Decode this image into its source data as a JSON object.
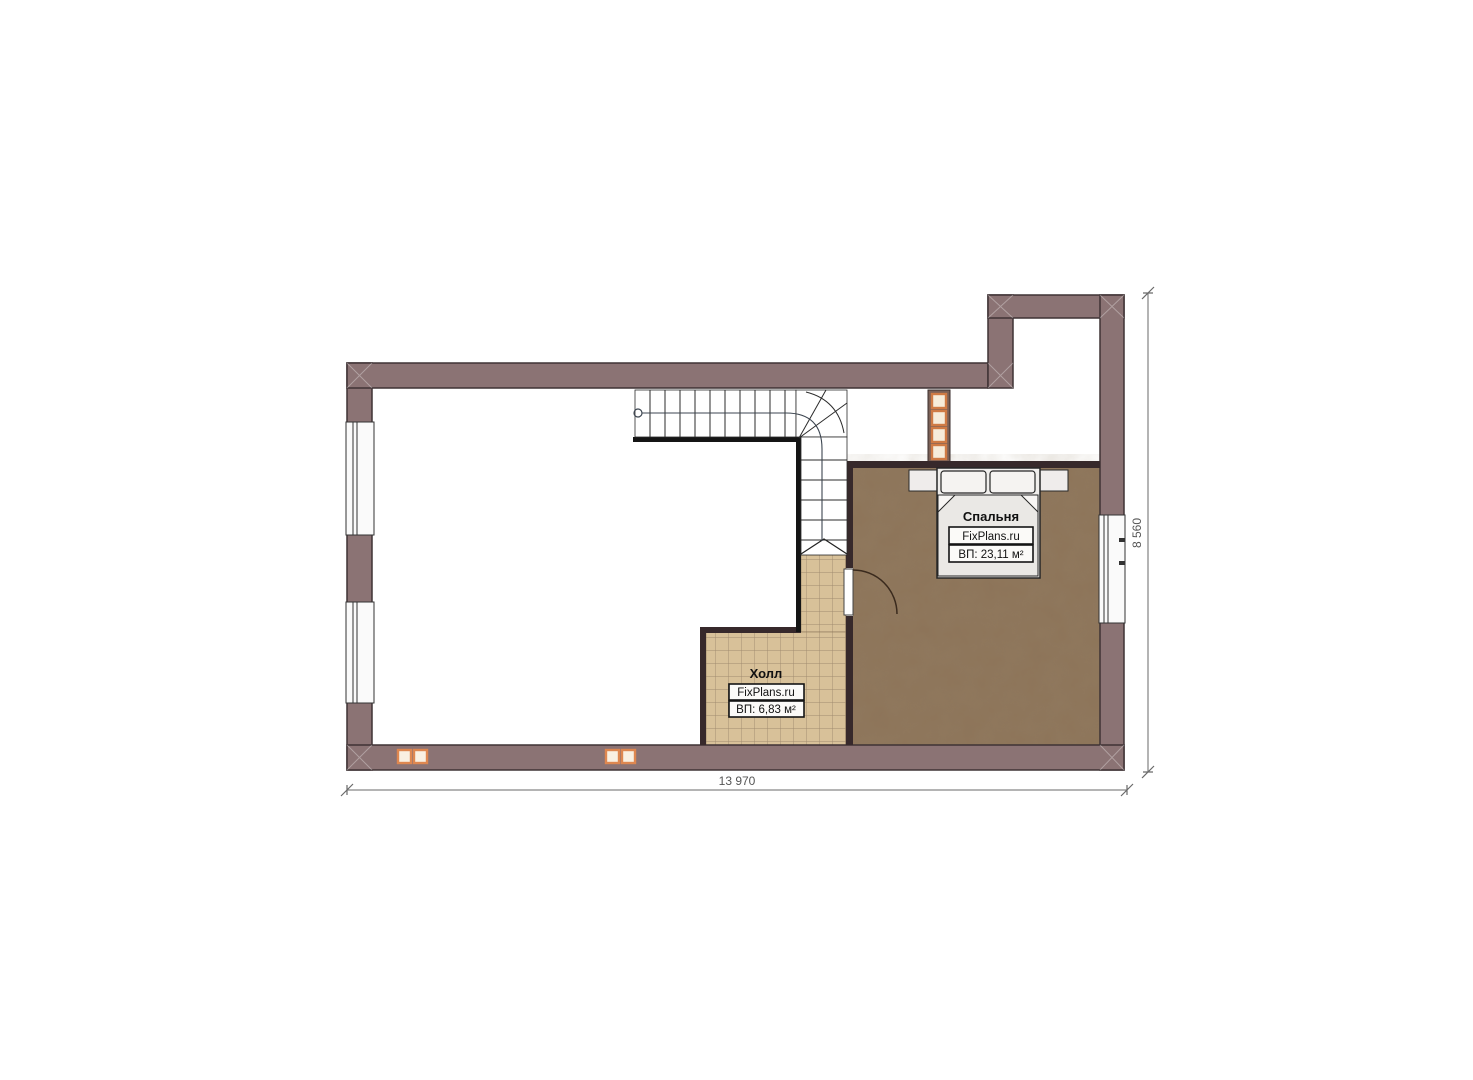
{
  "plan": {
    "type": "floor-plan",
    "rooms": {
      "bedroom": {
        "title": "Спальня",
        "brand": "FixPlans.ru",
        "area": "ВП: 23,11 м²"
      },
      "hall": {
        "title": "Холл",
        "brand": "FixPlans.ru",
        "area": "ВП: 6,83 м²"
      }
    },
    "dimensions": {
      "width": "13 970",
      "height": "8 560"
    },
    "colors": {
      "wall": "#8b7374",
      "wall_outline": "#3f3335",
      "partition": "#37292b",
      "bedroom_floor": "#8d7459",
      "hall_tile": "#d8c199",
      "tile_grid": "#a08a6e",
      "flue_wall": "#7b6157",
      "vent_accent": "#de8750",
      "vent_fill": "#f9f0e2",
      "dimension_line": "#6a6a6a"
    }
  }
}
